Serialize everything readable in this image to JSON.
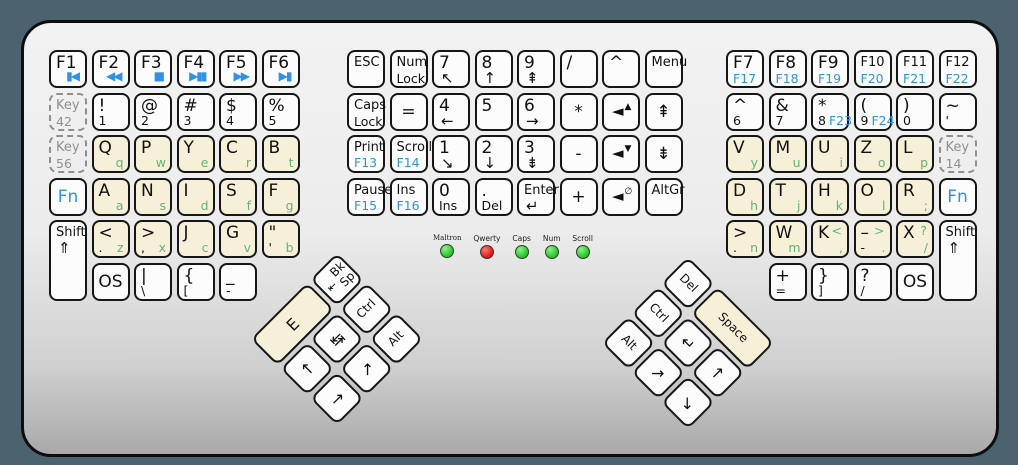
{
  "colors": {
    "background": "#4b636e",
    "body_top": "#f2f2f2",
    "body_bottom": "#a9a9a9",
    "key_border": "#161616",
    "cream_key": "#f6f0d8",
    "white_key": "#fcfcfc",
    "blue_accent": "#2e93e8",
    "green_accent": "#5fb578",
    "dashed_gray": "#8f8f8f",
    "led_green": "#1ec51e",
    "led_red": "#d91414"
  },
  "leds": {
    "items": [
      {
        "label": "Maltron",
        "color": "green"
      },
      {
        "label": "Qwerty",
        "color": "red"
      },
      {
        "label": "Caps",
        "color": "green"
      },
      {
        "label": "Num",
        "color": "green"
      },
      {
        "label": "Scroll",
        "color": "green"
      }
    ]
  },
  "blocks": {
    "left": {
      "rows": [
        [
          {
            "n": "key-f1",
            "t": "F1",
            "ic": {
              "t": "▮◀",
              "c": "blue",
              "p": "br",
              "n": "skip-back-icon"
            }
          },
          {
            "n": "key-f2",
            "t": "F2",
            "ic": {
              "t": "◀◀",
              "c": "blue",
              "p": "br",
              "n": "rewind-icon"
            }
          },
          {
            "n": "key-f3",
            "t": "F3",
            "ic": {
              "t": "■",
              "c": "blue",
              "p": "br",
              "n": "stop-icon"
            }
          },
          {
            "n": "key-f4",
            "t": "F4",
            "ic": {
              "t": "▶▮▮",
              "c": "blue",
              "p": "br",
              "n": "play-pause-icon"
            }
          },
          {
            "n": "key-f5",
            "t": "F5",
            "ic": {
              "t": "▶▶",
              "c": "blue",
              "p": "br",
              "n": "fast-forward-icon"
            }
          },
          {
            "n": "key-f6",
            "t": "F6",
            "ic": {
              "t": "▶▮",
              "c": "blue",
              "p": "br",
              "n": "skip-forward-icon"
            }
          }
        ],
        [
          {
            "n": "key-42",
            "s": "d",
            "t": "Key",
            "t2": "42"
          },
          {
            "n": "key-exclaim-1",
            "t": "!",
            "bl": "1"
          },
          {
            "n": "key-at-2",
            "t": "@",
            "bl": "2"
          },
          {
            "n": "key-hash-3",
            "t": "#",
            "bl": "3"
          },
          {
            "n": "key-dollar-4",
            "t": "$",
            "bl": "4"
          },
          {
            "n": "key-percent-5",
            "t": "%",
            "bl": "5"
          }
        ],
        [
          {
            "n": "key-56",
            "s": "d",
            "t": "Key",
            "t2": "56"
          },
          {
            "n": "key-q",
            "s": "c",
            "t": "Q",
            "br": "q"
          },
          {
            "n": "key-p",
            "s": "c",
            "t": "P",
            "br": "w"
          },
          {
            "n": "key-y",
            "s": "c",
            "t": "Y",
            "br": "e"
          },
          {
            "n": "key-c",
            "s": "c",
            "t": "C",
            "br": "r"
          },
          {
            "n": "key-b",
            "s": "c",
            "t": "B",
            "br": "t"
          }
        ],
        [
          {
            "n": "key-fn-left",
            "s": "fn",
            "t": "Fn",
            "ctr": true
          },
          {
            "n": "key-a",
            "s": "c",
            "t": "A",
            "br": "a"
          },
          {
            "n": "key-n",
            "s": "c",
            "t": "N",
            "br": "s"
          },
          {
            "n": "key-i",
            "s": "c",
            "t": "I",
            "br": "d"
          },
          {
            "n": "key-s",
            "s": "c",
            "t": "S",
            "br": "f"
          },
          {
            "n": "key-f",
            "s": "c",
            "t": "F",
            "br": "g"
          }
        ],
        [
          {
            "n": "key-shift-left",
            "t": "Shift",
            "t2": "⇑",
            "h": 2
          },
          {
            "n": "key-less-dot",
            "s": "c",
            "t": "<",
            "bl": ".",
            "br": "z"
          },
          {
            "n": "key-greater-comma",
            "s": "c",
            "t": ">",
            "bl": ",",
            "br": "x"
          },
          {
            "n": "key-j",
            "s": "c",
            "t": "J",
            "br": "c"
          },
          {
            "n": "key-g",
            "s": "c",
            "t": "G",
            "br": "v"
          },
          {
            "n": "key-quote",
            "s": "c",
            "t": "\"",
            "bl": "'",
            "br": "b"
          }
        ],
        [
          {
            "n": "key-os-left",
            "t": "OS",
            "ctr": true,
            "col": 2
          },
          {
            "n": "key-pipe-backslash",
            "t": "|",
            "bl": "\\",
            "col": 3
          },
          {
            "n": "key-brace-bracket-left",
            "t": "{",
            "bl": "[",
            "col": 4
          },
          {
            "n": "key-underscore-dash",
            "t": "_",
            "bl": "-",
            "col": 5
          }
        ]
      ]
    },
    "middle": {
      "rows": [
        [
          {
            "n": "key-esc",
            "t": "ESC"
          },
          {
            "n": "key-num-lock",
            "t": "Num",
            "t2": "Lock"
          },
          {
            "n": "key-np7",
            "t": "7",
            "t2": "↖"
          },
          {
            "n": "key-np8",
            "t": "8",
            "t2": "↑"
          },
          {
            "n": "key-np9",
            "t": "9",
            "t2": "⇞"
          },
          {
            "n": "key-np-divide",
            "t": "/"
          },
          {
            "n": "key-caret-mid",
            "t": "^"
          },
          {
            "n": "key-menu",
            "t": "Menu"
          }
        ],
        [
          {
            "n": "key-caps-lock",
            "t": "Caps",
            "t2": "Lock"
          },
          {
            "n": "key-equals",
            "t": "=",
            "ctr": true
          },
          {
            "n": "key-np4",
            "t": "4",
            "t2": "←"
          },
          {
            "n": "key-np5",
            "t": "5"
          },
          {
            "n": "key-np6",
            "t": "6",
            "t2": "→"
          },
          {
            "n": "key-np-multiply",
            "t": "*",
            "ctr": true
          },
          {
            "n": "key-volume-up",
            "ic": {
              "t": "◄",
              "c": "black",
              "p": "c",
              "n": "volume-up-icon"
            },
            "ic2": "▲"
          },
          {
            "n": "key-page-up",
            "t": "⇞",
            "ctr": true
          }
        ],
        [
          {
            "n": "key-print",
            "t": "Print",
            "bl": "F13",
            "blc": "blue"
          },
          {
            "n": "key-scroll-lock",
            "t": "Scroll",
            "bl": "F14",
            "blc": "blue"
          },
          {
            "n": "key-np1",
            "t": "1",
            "t2": "↘"
          },
          {
            "n": "key-np2",
            "t": "2",
            "t2": "↓"
          },
          {
            "n": "key-np3",
            "t": "3",
            "t2": "⇟"
          },
          {
            "n": "key-np-minus",
            "t": "-",
            "ctr": true
          },
          {
            "n": "key-volume-down",
            "ic": {
              "t": "◄",
              "c": "black",
              "p": "c",
              "n": "volume-down-icon"
            },
            "ic2": "▼"
          },
          {
            "n": "key-page-down",
            "t": "⇟",
            "ctr": true
          }
        ],
        [
          {
            "n": "key-pause",
            "t": "Pause",
            "bl": "F15",
            "blc": "blue"
          },
          {
            "n": "key-ins",
            "t": "Ins",
            "bl": "F16",
            "blc": "blue"
          },
          {
            "n": "key-np0",
            "t": "0",
            "bl": "Ins"
          },
          {
            "n": "key-np-dot",
            "t": ".",
            "bl": "Del"
          },
          {
            "n": "key-enter",
            "t": "Enter",
            "t2": "↵"
          },
          {
            "n": "key-np-plus",
            "t": "+",
            "ctr": true
          },
          {
            "n": "key-mute",
            "ic": {
              "t": "◄",
              "c": "black",
              "p": "c",
              "n": "mute-icon"
            },
            "ic2": "∅"
          },
          {
            "n": "key-altgr",
            "t": "AltGr"
          }
        ]
      ]
    },
    "right": {
      "rows": [
        [
          {
            "n": "key-f7",
            "t": "F7",
            "t2": "F17",
            "t2c": "blue"
          },
          {
            "n": "key-f8",
            "t": "F8",
            "t2": "F18",
            "t2c": "blue"
          },
          {
            "n": "key-f9",
            "t": "F9",
            "t2": "F19",
            "t2c": "blue"
          },
          {
            "n": "key-f10",
            "t": "F10",
            "t2": "F20",
            "t2c": "blue"
          },
          {
            "n": "key-f11",
            "t": "F11",
            "t2": "F21",
            "t2c": "blue"
          },
          {
            "n": "key-f12",
            "t": "F12",
            "t2": "F22",
            "t2c": "blue"
          }
        ],
        [
          {
            "n": "key-caret-6",
            "t": "^",
            "bl": "6"
          },
          {
            "n": "key-amp-7",
            "t": "&",
            "bl": "7"
          },
          {
            "n": "key-star-8",
            "t": "*",
            "bl": "8",
            "bl2": "F23"
          },
          {
            "n": "key-paren-9",
            "t": "(",
            "bl": "9",
            "bl2": "F24"
          },
          {
            "n": "key-paren-0",
            "t": ")",
            "bl": "0"
          },
          {
            "n": "key-tilde-apostrophe",
            "t": "~",
            "bl": "'"
          }
        ],
        [
          {
            "n": "key-v",
            "s": "c",
            "t": "V",
            "br": "y"
          },
          {
            "n": "key-m",
            "s": "c",
            "t": "M",
            "br": "u"
          },
          {
            "n": "key-u",
            "s": "c",
            "t": "U",
            "br": "i"
          },
          {
            "n": "key-z",
            "s": "c",
            "t": "Z",
            "br": "o"
          },
          {
            "n": "key-l",
            "s": "c",
            "t": "L",
            "br": "p"
          },
          {
            "n": "key-14",
            "s": "d",
            "t": "Key",
            "t2": "14"
          }
        ],
        [
          {
            "n": "key-d",
            "s": "c",
            "t": "D",
            "br": "h"
          },
          {
            "n": "key-t",
            "s": "c",
            "t": "T",
            "br": "j"
          },
          {
            "n": "key-h",
            "s": "c",
            "t": "H",
            "br": "k"
          },
          {
            "n": "key-o",
            "s": "c",
            "t": "O",
            "br": "l"
          },
          {
            "n": "key-r",
            "s": "c",
            "t": "R",
            "br": ";"
          },
          {
            "n": "key-fn-right",
            "s": "fn",
            "t": "Fn",
            "ctr": true
          }
        ],
        [
          {
            "n": "key-greater-dot-n",
            "s": "c",
            "t": ">",
            "bl": ".",
            "br": "n"
          },
          {
            "n": "key-w",
            "s": "c",
            "t": "W",
            "br": "m"
          },
          {
            "n": "key-k",
            "s": "c",
            "t": "K",
            "tr": "<",
            "br": ","
          },
          {
            "n": "key-dash",
            "s": "c",
            "t": "–",
            "tr": ">",
            "bl": "-",
            "br": "."
          },
          {
            "n": "key-x",
            "s": "c",
            "t": "X",
            "tr": "?",
            "br": "/"
          },
          {
            "n": "key-shift-right",
            "t": "Shift",
            "t2": "⇑",
            "h": 2
          }
        ],
        [
          {
            "n": "key-plus-equals",
            "t": "+",
            "bl": "=",
            "col": 2
          },
          {
            "n": "key-brace-bracket-right",
            "t": "}",
            "bl": "]",
            "col": 3
          },
          {
            "n": "key-question-slash",
            "t": "?",
            "bl": "/",
            "col": 4
          },
          {
            "n": "key-os-right",
            "t": "OS",
            "ctr": true,
            "col": 5
          }
        ]
      ]
    },
    "left_thumb": {
      "keys": [
        {
          "n": "key-e-thumb",
          "s": "c",
          "t": "E",
          "gx": 1,
          "gy": 1,
          "w": 2,
          "ctr": true
        },
        {
          "n": "key-backspace",
          "t": "Bk Sp",
          "ic": {
            "t": "⇤",
            "c": "black",
            "p": "l",
            "n": "backspace-arrow-icon"
          },
          "gx": 3,
          "gy": 1
        },
        {
          "n": "key-arrow-up-left",
          "t": "↑",
          "gx": 1,
          "gy": 2,
          "ctr": true
        },
        {
          "n": "key-tab",
          "t": "↹",
          "gx": 2,
          "gy": 2,
          "ctr": true
        },
        {
          "n": "key-ctrl-left",
          "t": "Ctrl",
          "gx": 3,
          "gy": 2,
          "ctr": true
        },
        {
          "n": "key-arrow-low-left",
          "t": "→",
          "gx": 1,
          "gy": 3,
          "ctr": true
        },
        {
          "n": "key-arrow-mid-left",
          "t": "↗",
          "gx": 2,
          "gy": 3,
          "ctr": true
        },
        {
          "n": "key-alt-left",
          "t": "Alt",
          "gx": 3,
          "gy": 3,
          "ctr": true
        }
      ]
    },
    "right_thumb": {
      "keys": [
        {
          "n": "key-del-thumb",
          "t": "Del",
          "gx": 1,
          "gy": 1,
          "ctr": true
        },
        {
          "n": "key-space-thumb",
          "s": "c",
          "t": "Space",
          "gx": 2,
          "gy": 1,
          "w": 2,
          "ctr": true
        },
        {
          "n": "key-ctrl-right",
          "t": "Ctrl",
          "gx": 1,
          "gy": 2,
          "ctr": true
        },
        {
          "n": "key-return-thumb",
          "t": "↵",
          "gx": 2,
          "gy": 2,
          "ctr": true
        },
        {
          "n": "key-arrow-up-right",
          "t": "↑",
          "gx": 3,
          "gy": 2,
          "ctr": true
        },
        {
          "n": "key-alt-right",
          "t": "Alt",
          "gx": 1,
          "gy": 3,
          "ctr": true
        },
        {
          "n": "key-arrow-mid-right",
          "t": "↗",
          "gx": 2,
          "gy": 3,
          "ctr": true
        },
        {
          "n": "key-arrow-low-right",
          "t": "↘",
          "gx": 3,
          "gy": 3,
          "ctr": true
        }
      ]
    }
  }
}
